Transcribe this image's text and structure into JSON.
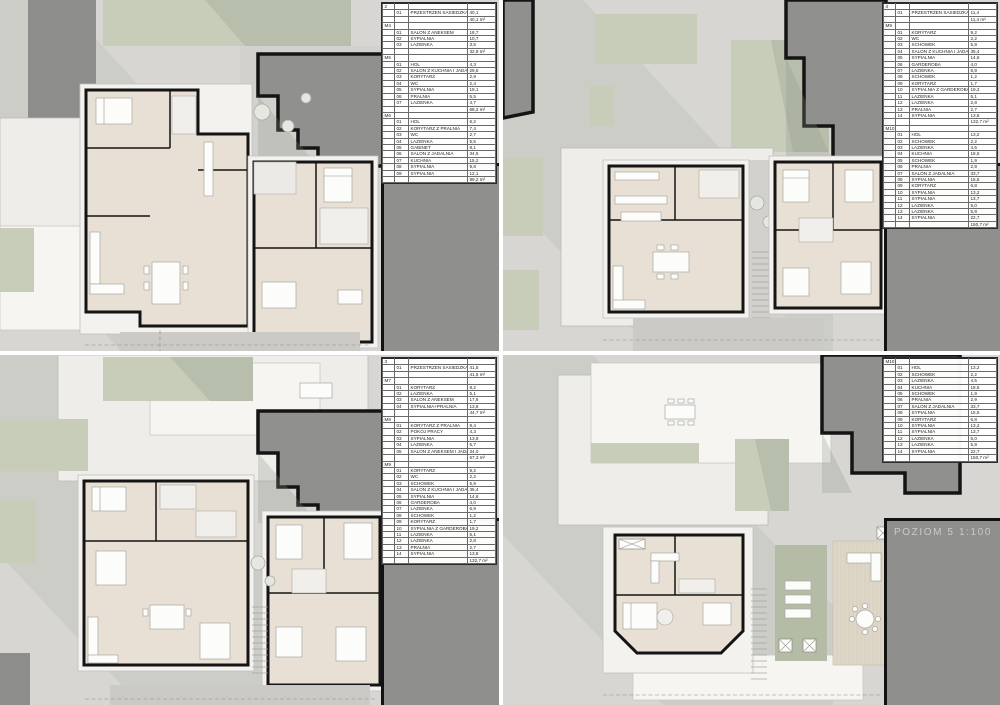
{
  "sheet": {
    "description": "Architectural floor plan sheet with four levels",
    "scale": "1:100"
  },
  "colors": {
    "site_background": "#d7d6d2",
    "greenery": "#c7cdb9",
    "neighbor_mass": "#90918e",
    "level_band": "#8f908d",
    "room_floor": "#e8e0d5",
    "wall": "#141414",
    "band_text": "#c9c9c6"
  },
  "panels": [
    {
      "id": "poziom-2",
      "band_label": "POZIOM 2  1:100",
      "sections": [
        {
          "code": "2",
          "rows": [
            [
              "01",
              "PRZESTRZEN SASIEDZKA",
              "40,1"
            ]
          ],
          "total": "40,1 m²"
        },
        {
          "code": "M4",
          "rows": [
            [
              "01",
              "SALON Z ANEKSEM",
              "18,7"
            ],
            [
              "02",
              "SYPIALNIA",
              "10,7"
            ],
            [
              "03",
              "LAZIENKA",
              "3,5"
            ]
          ],
          "total": "32,9 m²"
        },
        {
          "code": "M5",
          "rows": [
            [
              "01",
              "HOL",
              "4,3"
            ],
            [
              "02",
              "SALON Z KUCHNIA I JADALNIA",
              "29,5"
            ],
            [
              "03",
              "KORYTARZ",
              "2,9"
            ],
            [
              "04",
              "WC",
              "2,4"
            ],
            [
              "05",
              "SYPIALNIA",
              "19,1"
            ],
            [
              "06",
              "PRALNIA",
              "5,5"
            ],
            [
              "07",
              "LAZIENKA",
              "4,7"
            ]
          ],
          "total": "68,2 m²"
        },
        {
          "code": "M6",
          "rows": [
            [
              "01",
              "HOL",
              "6,2"
            ],
            [
              "02",
              "KORYTARZ Z PRALNIA",
              "7,4"
            ],
            [
              "03",
              "WC",
              "2,7"
            ],
            [
              "04",
              "LAZIENKA",
              "5,5"
            ],
            [
              "05",
              "GABINET",
              "8,1"
            ],
            [
              "06",
              "SALON Z JADALNIA",
              "34,5"
            ],
            [
              "07",
              "KUCHNIA",
              "15,2"
            ],
            [
              "08",
              "SYPIALNIA",
              "9,8"
            ],
            [
              "09",
              "SYPIALNIA",
              "12,1"
            ]
          ],
          "total": "99,2 m²"
        }
      ]
    },
    {
      "id": "poziom-4",
      "band_label": "POZIOM 4  1:100",
      "sections": [
        {
          "code": "4",
          "rows": [
            [
              "01",
              "PRZESTRZEN SASIEDZKA",
              "11,4"
            ]
          ],
          "total": "11,4 m²"
        },
        {
          "code": "M9",
          "rows": [
            [
              "01",
              "KORYTARZ",
              "9,2"
            ],
            [
              "02",
              "WC",
              "2,2"
            ],
            [
              "03",
              "SCHOWEK",
              "5,9"
            ],
            [
              "04",
              "SALON Z KUCHNIA I JADALNIA",
              "35,4"
            ],
            [
              "05",
              "SYPIALNIA",
              "14,6"
            ],
            [
              "06",
              "GARDEROBA",
              "4,0"
            ],
            [
              "07",
              "LAZIENKA",
              "6,9"
            ],
            [
              "08",
              "SCHOWEK",
              "1,2"
            ],
            [
              "09",
              "KORYTARZ",
              "1,7"
            ],
            [
              "10",
              "SYPIALNIA Z GARDEROBA",
              "19,2"
            ],
            [
              "11",
              "LAZIENKA",
              "5,1"
            ],
            [
              "12",
              "LAZIENKA",
              "2,8"
            ],
            [
              "13",
              "PRALNIA",
              "2,7"
            ],
            [
              "14",
              "SYPIALNIA",
              "13,8"
            ]
          ],
          "total": "132,7 m²"
        },
        {
          "code": "M10",
          "rows": [
            [
              "01",
              "HOL",
              "13,2"
            ],
            [
              "02",
              "SCHOWEK",
              "2,2"
            ],
            [
              "03",
              "LAZIENKA",
              "4,5"
            ],
            [
              "04",
              "KUCHNIA",
              "18,5"
            ],
            [
              "05",
              "SCHOWEK",
              "1,9"
            ],
            [
              "06",
              "PRALNIA",
              "2,9"
            ],
            [
              "07",
              "SALON Z JADALNIA",
              "33,7"
            ],
            [
              "08",
              "SYPIALNIA",
              "15,5"
            ],
            [
              "09",
              "KORYTARZ",
              "6,8"
            ],
            [
              "10",
              "SYPIALNIA",
              "13,2"
            ],
            [
              "11",
              "SYPIALNIA",
              "13,7"
            ],
            [
              "12",
              "LAZIENKA",
              "5,0"
            ],
            [
              "13",
              "LAZIENKA",
              "5,9"
            ],
            [
              "14",
              "SYPIALNIA",
              "22,7"
            ]
          ],
          "total": "150,7 m²"
        }
      ]
    },
    {
      "id": "poziom-3",
      "band_label": "POZIOM 3  1:100",
      "sections": [
        {
          "code": "3",
          "rows": [
            [
              "01",
              "PRZESTRZEN SASIEDZKA",
              "41,5"
            ]
          ],
          "total": "41,5 m²"
        },
        {
          "code": "M7",
          "rows": [
            [
              "01",
              "KORYTARZ",
              "8,2"
            ],
            [
              "02",
              "LAZIENKA",
              "5,1"
            ],
            [
              "03",
              "SALON Z ANEKSEM",
              "17,6"
            ],
            [
              "04",
              "SYPIALNIA+PRALNIA",
              "13,8"
            ]
          ],
          "total": "44,7 m²"
        },
        {
          "code": "M8",
          "rows": [
            [
              "01",
              "KORYTARZ Z PRALNIA",
              "9,4"
            ],
            [
              "02",
              "POKOJ PRACY",
              "4,3"
            ],
            [
              "03",
              "SYPIALNIA",
              "13,9"
            ],
            [
              "04",
              "LAZIENKA",
              "5,7"
            ],
            [
              "05",
              "SALON Z ANEKSEM I JADALNIA",
              "34,0"
            ]
          ],
          "total": "67,3 m²"
        },
        {
          "code": "M9",
          "rows": [
            [
              "01",
              "KORYTARZ",
              "9,2"
            ],
            [
              "02",
              "WC",
              "2,2"
            ],
            [
              "03",
              "SCHOWEK",
              "5,9"
            ],
            [
              "04",
              "SALON Z KUCHNIA I JADALNIA",
              "35,4"
            ],
            [
              "05",
              "SYPIALNIA",
              "14,6"
            ],
            [
              "06",
              "GARDEROBA",
              "4,0"
            ],
            [
              "07",
              "LAZIENKA",
              "6,9"
            ],
            [
              "08",
              "SCHOWEK",
              "1,2"
            ],
            [
              "09",
              "KORYTARZ",
              "1,7"
            ],
            [
              "10",
              "SYPIALNIA Z GARDEROBA",
              "19,2"
            ],
            [
              "11",
              "LAZIENKA",
              "5,1"
            ],
            [
              "12",
              "LAZIENKA",
              "2,8"
            ],
            [
              "13",
              "PRALNIA",
              "2,7"
            ],
            [
              "14",
              "SYPIALNIA",
              "13,8"
            ]
          ],
          "total": "132,7 m²"
        }
      ]
    },
    {
      "id": "poziom-5",
      "band_label": "POZIOM 5  1:100",
      "sections": [
        {
          "code": "M10",
          "rows": [
            [
              "01",
              "HOL",
              "13,2"
            ],
            [
              "02",
              "SCHOWEK",
              "2,2"
            ],
            [
              "03",
              "LAZIENKA",
              "4,5"
            ],
            [
              "04",
              "KUCHNIA",
              "18,5"
            ],
            [
              "05",
              "SCHOWEK",
              "1,9"
            ],
            [
              "06",
              "PRALNIA",
              "2,9"
            ],
            [
              "07",
              "SALON Z JADALNIA",
              "33,7"
            ],
            [
              "08",
              "SYPIALNIA",
              "15,5"
            ],
            [
              "09",
              "KORYTARZ",
              "6,8"
            ],
            [
              "10",
              "SYPIALNIA",
              "13,2"
            ],
            [
              "11",
              "SYPIALNIA",
              "13,7"
            ],
            [
              "12",
              "LAZIENKA",
              "5,0"
            ],
            [
              "13",
              "LAZIENKA",
              "5,9"
            ],
            [
              "14",
              "SYPIALNIA",
              "22,7"
            ]
          ],
          "total": "150,7 m²"
        }
      ]
    }
  ]
}
